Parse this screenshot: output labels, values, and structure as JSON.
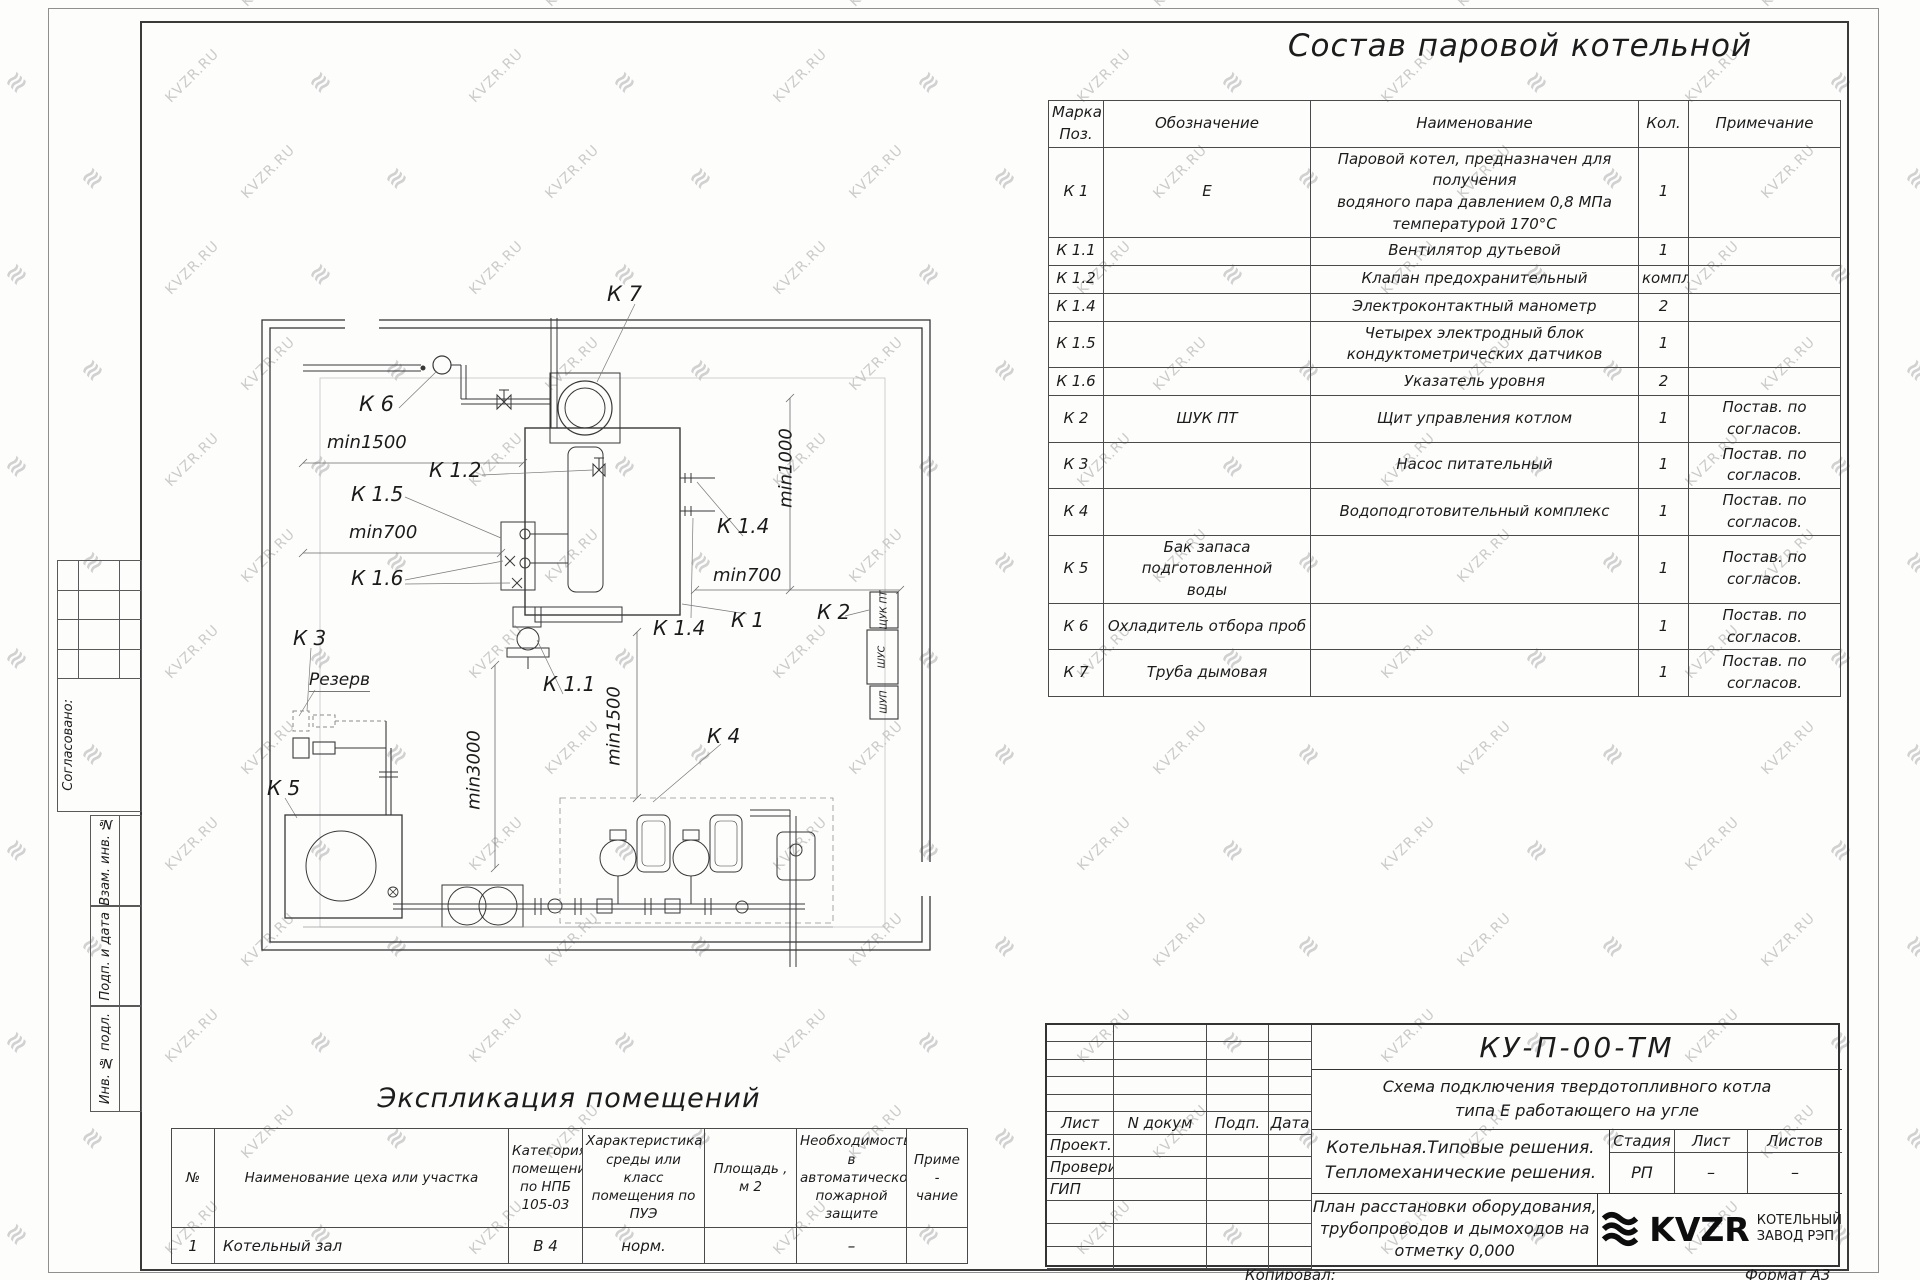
{
  "watermark": {
    "text": "KVZR.RU",
    "logo_glyph": "≋"
  },
  "titles": {
    "equipment_table": "Состав паровой котельной",
    "room_table": "Экспликация помещений"
  },
  "equipment_table": {
    "headers": [
      "Марка\nПоз.",
      "Обозначение",
      "Наименование",
      "Кол.",
      "Примечание"
    ],
    "rows": [
      {
        "mark": "К 1",
        "designation": "Е",
        "name": "Паровой котел, предназначен для получения\nводяного пара давлением 0,8 МПа\nтемпературой 170°С",
        "qty": "1",
        "note": ""
      },
      {
        "mark": "К 1.1",
        "designation": "",
        "name": "Вентилятор дутьевой",
        "qty": "1",
        "note": ""
      },
      {
        "mark": "К 1.2",
        "designation": "",
        "name": "Клапан предохранительный",
        "qty": "компл.",
        "note": ""
      },
      {
        "mark": "К 1.4",
        "designation": "",
        "name": "Электроконтактный манометр",
        "qty": "2",
        "note": ""
      },
      {
        "mark": "К 1.5",
        "designation": "",
        "name": "Четырех электродный блок\nкондуктометрических датчиков",
        "qty": "1",
        "note": ""
      },
      {
        "mark": "К 1.6",
        "designation": "",
        "name": "Указатель уровня",
        "qty": "2",
        "note": ""
      },
      {
        "mark": "К 2",
        "designation": "ШУК ПТ",
        "name": "Щит управления котлом",
        "qty": "1",
        "note": "Постав. по согласов."
      },
      {
        "mark": "К 3",
        "designation": "",
        "name": "Насос питательный",
        "qty": "1",
        "note": "Постав. по согласов."
      },
      {
        "mark": "К 4",
        "designation": "",
        "name": "Водоподготовительный комплекс",
        "qty": "1",
        "note": "Постав. по согласов."
      },
      {
        "mark": "К 5",
        "designation": "Бак запаса подготовленной\nводы",
        "name": "",
        "qty": "1",
        "note": "Постав. по согласов."
      },
      {
        "mark": "К 6",
        "designation": "Охладитель отбора проб",
        "name": "",
        "qty": "1",
        "note": "Постав. по согласов."
      },
      {
        "mark": "К 7",
        "designation": "Труба дымовая",
        "name": "",
        "qty": "1",
        "note": "Постав. по согласов."
      }
    ]
  },
  "room_table": {
    "headers": [
      "№",
      "Наименование цеха или участка",
      "Категория\nпомещения\nпо НПБ\n105-03",
      "Характеристика\nсреды или класс\nпомещения по\nПУЭ",
      "Площадь ,\nм 2",
      "Необходимость в\nавтоматической\nпожарной защите",
      "Приме -\nчание"
    ],
    "row": [
      "1",
      "Котельный зал",
      "В 4",
      "норм.",
      "",
      "–",
      ""
    ]
  },
  "plan": {
    "labels": [
      {
        "t": "К 7",
        "x": 362,
        "y": 12,
        "fs": 21
      },
      {
        "t": "К 6",
        "x": 114,
        "y": 122,
        "fs": 21
      },
      {
        "t": "min1500",
        "x": 82,
        "y": 162,
        "fs": 18
      },
      {
        "t": "К 1.2",
        "x": 184,
        "y": 188,
        "fs": 20
      },
      {
        "t": "К 1.5",
        "x": 106,
        "y": 212,
        "fs": 20
      },
      {
        "t": "min700",
        "x": 104,
        "y": 252,
        "fs": 18
      },
      {
        "t": "К 1.6",
        "x": 106,
        "y": 296,
        "fs": 20
      },
      {
        "t": "К 3",
        "x": 48,
        "y": 356,
        "fs": 20
      },
      {
        "t": "Резерв",
        "x": 64,
        "y": 400,
        "fs": 17,
        "u": 1
      },
      {
        "t": "К 5",
        "x": 22,
        "y": 506,
        "fs": 20
      },
      {
        "t": "К 1.1",
        "x": 298,
        "y": 402,
        "fs": 20
      },
      {
        "t": "min3000",
        "cx": 229,
        "cy": 500,
        "fs": 18,
        "rot": 1
      },
      {
        "t": "min1500",
        "cx": 369,
        "cy": 456,
        "fs": 18,
        "rot": 1
      },
      {
        "t": "min1000",
        "cx": 541,
        "cy": 198,
        "fs": 18,
        "rot": 1
      },
      {
        "t": "К 1.4",
        "x": 472,
        "y": 244,
        "fs": 20
      },
      {
        "t": "min700",
        "x": 468,
        "y": 295,
        "fs": 18
      },
      {
        "t": "К 1.4",
        "x": 408,
        "y": 346,
        "fs": 20
      },
      {
        "t": "К 1",
        "x": 486,
        "y": 338,
        "fs": 20
      },
      {
        "t": "К 2",
        "x": 572,
        "y": 330,
        "fs": 20
      },
      {
        "t": "К 4",
        "x": 462,
        "y": 454,
        "fs": 20
      }
    ],
    "box_labels": [
      {
        "t": "ЩУК ПТ",
        "cx": 639,
        "cy": 340
      },
      {
        "t": "ШУС",
        "cx": 637,
        "cy": 387
      },
      {
        "t": "ШУП",
        "cx": 639,
        "cy": 432
      }
    ]
  },
  "side_stamps": [
    "Согласовано:",
    "Взам. инв. №",
    "Подп. и дата",
    "Инв. № подл."
  ],
  "title_block": {
    "doc_number": "КУ-П-00-ТМ",
    "scheme_line1": "Схема подключения твердотопливного котла",
    "scheme_line2": "типа Е работающего на угле",
    "object_line1": "Котельная.Типовые решения.",
    "object_line2": "Тепломеханические решения.",
    "sheet_title": "План расстановки оборудования,\nтрубопроводов и дымоходов на\nотметку 0,000",
    "header_row": [
      "Лист",
      "N докум",
      "Подп.",
      "Дата"
    ],
    "roles": [
      "Проект.",
      "Проверил",
      "ГИП"
    ],
    "stage_label": "Стадия",
    "sheet_label": "Лист",
    "sheets_label": "Листов",
    "stage": "РП",
    "sheet": "–",
    "sheets": "–",
    "logo_text": "KVZR",
    "company_line1": "КОТЕЛЬНЫЙ",
    "company_line2": "ЗАВОД РЭП",
    "copied_label": "Копировал:",
    "format_label": "Формат А3"
  }
}
